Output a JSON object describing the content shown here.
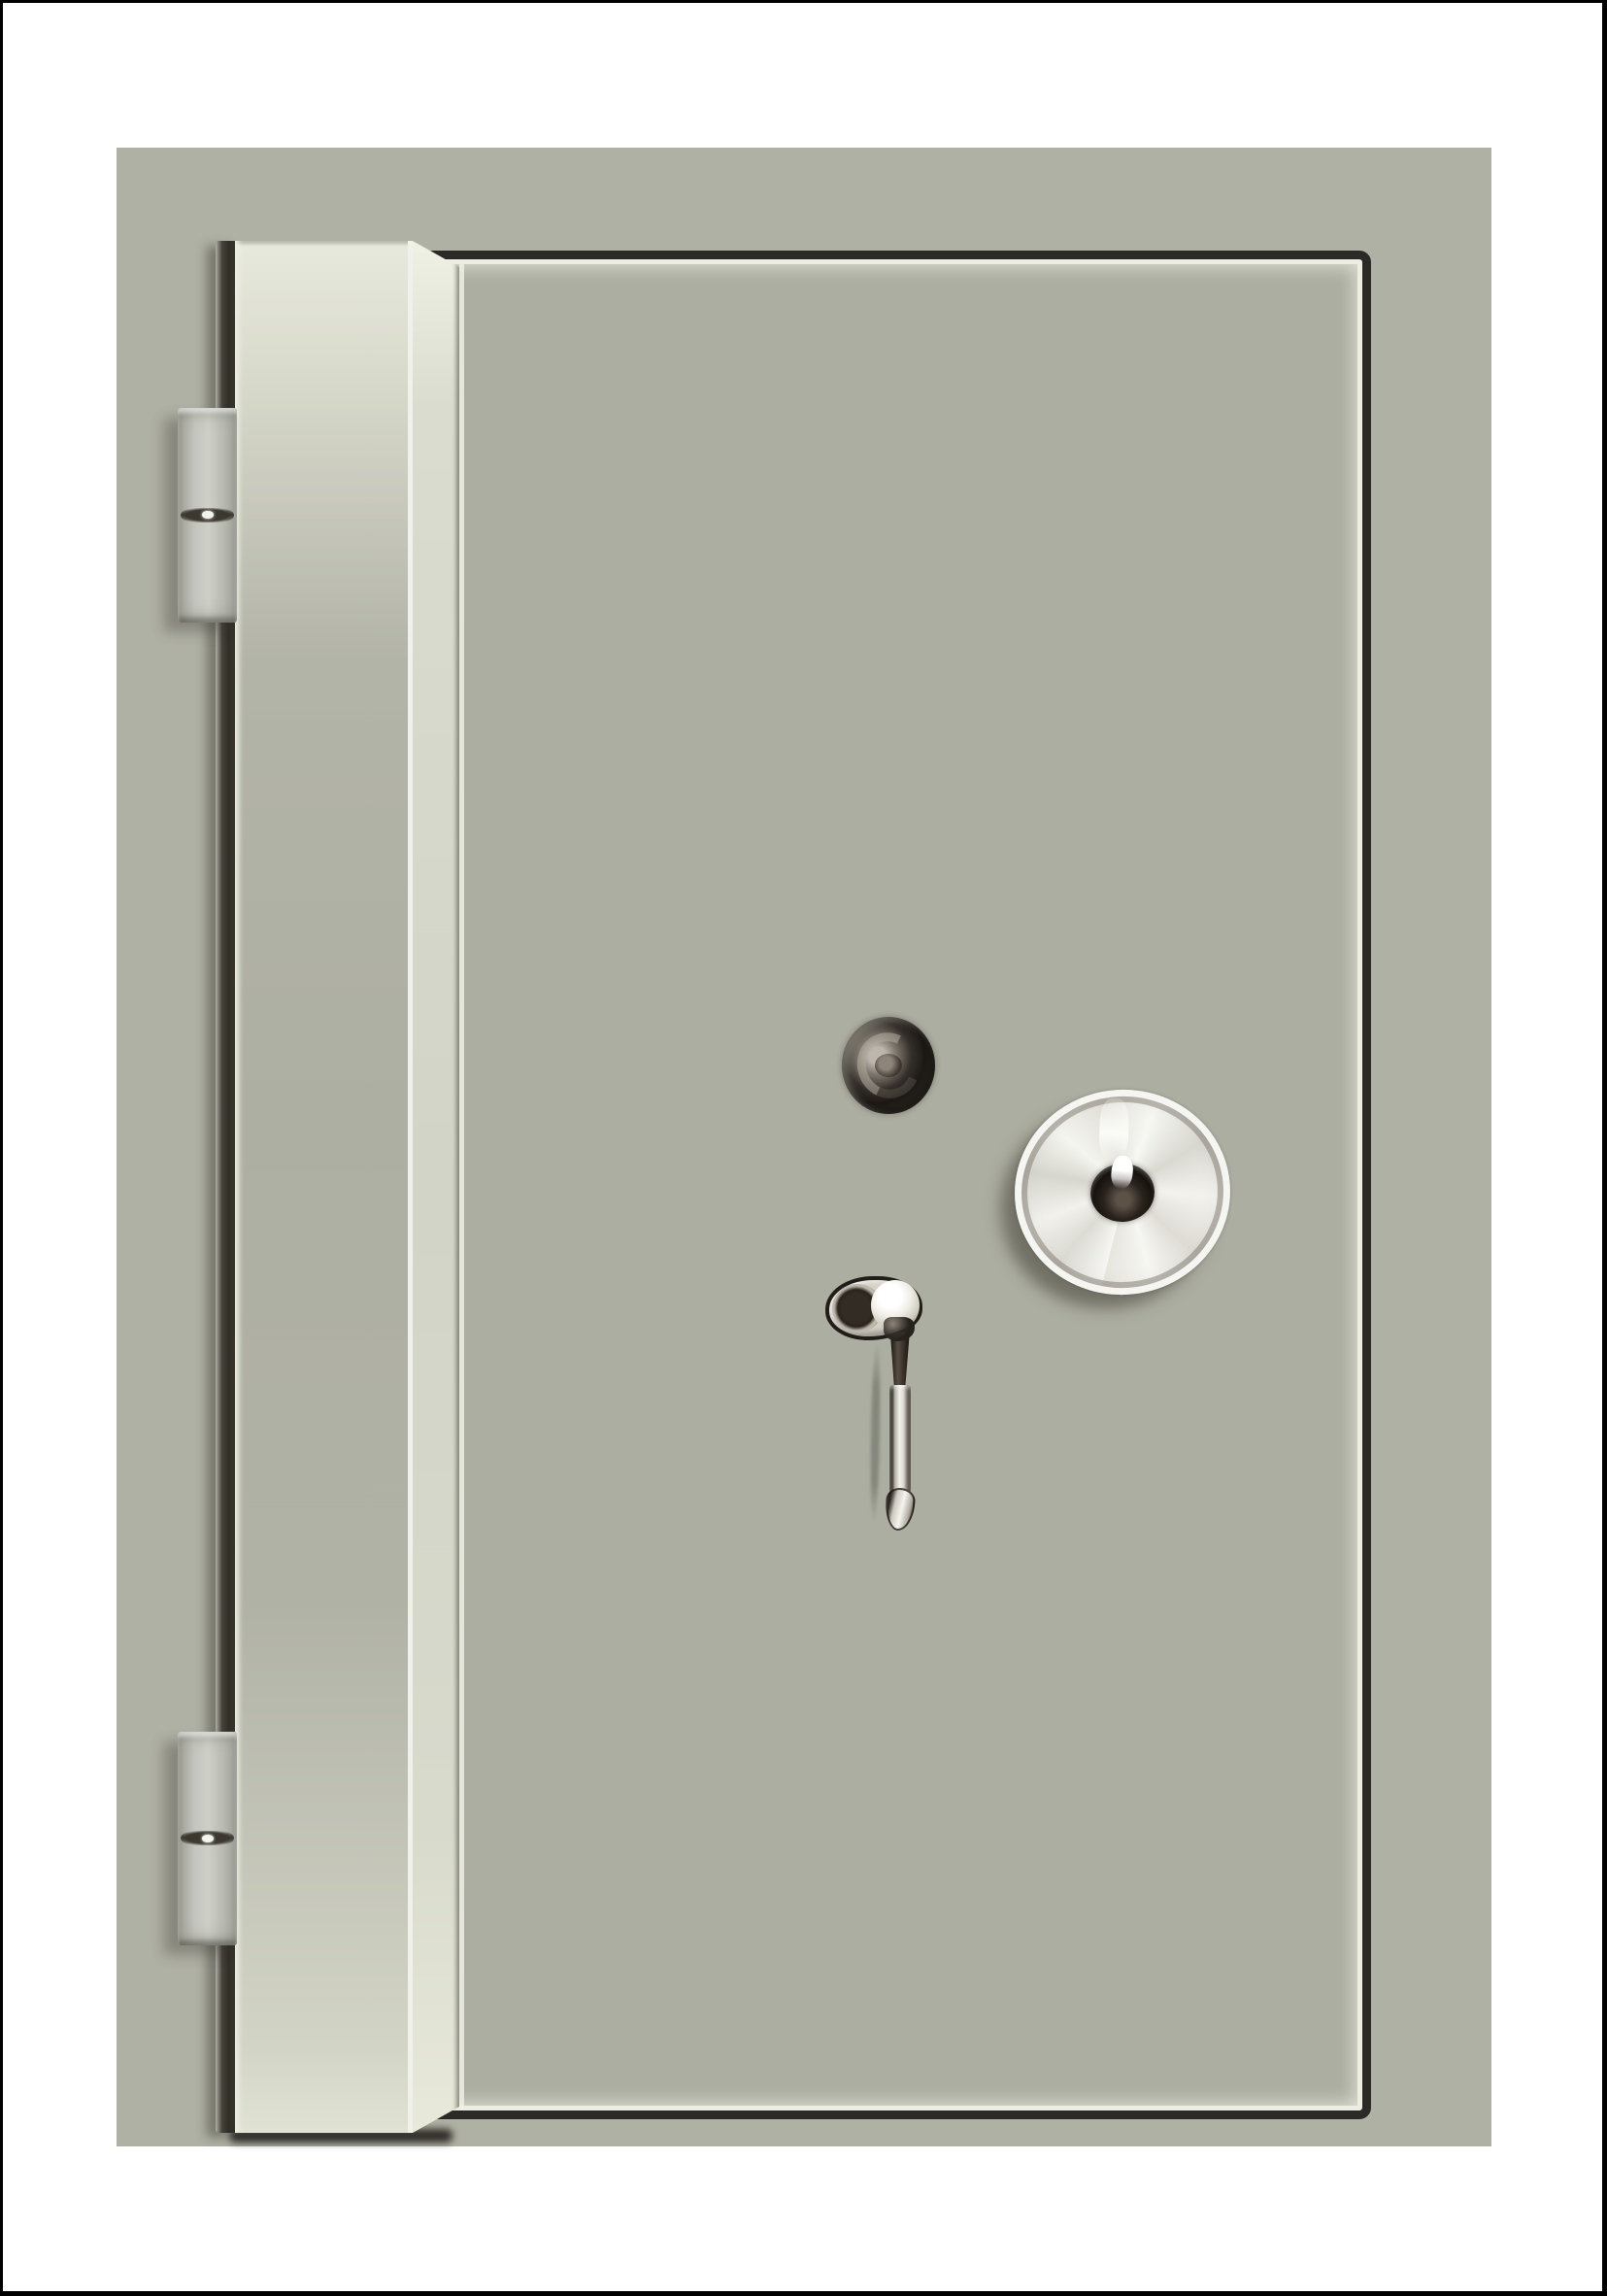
{
  "image": {
    "kind": "product-photo",
    "subject": "Free-standing security safe, front view, door closed",
    "orientation": "portrait"
  },
  "palette": {
    "canvas_bg": "#ffffff",
    "frame_border": "#000000",
    "safe_body": "#b0b1a5",
    "door_face": "#adaea2",
    "stile_highlight": "#dcded0",
    "groove_dark": "#2b2a26",
    "gap_shadow": "#332f29",
    "hinge_metal": "#c3c4bd",
    "dial_silver": "#f2f1ec",
    "dial_hub_dark": "#241e19",
    "keyhole_dark": "#2e2a25",
    "handle_bright": "#f3f2ed"
  },
  "parts": {
    "safe_body": "painted steel cabinet",
    "door_panel": "recessed door front with dark groove outline",
    "door_edge_stile": "protruding door edge with beveled corner",
    "hinge_top": "barrel hinge",
    "hinge_bottom": "barrel hinge",
    "keyhole": "round key lock",
    "combination_dial": "silver combination dial with dark center hub",
    "handle": "swing handle with round boss and drop lever"
  }
}
